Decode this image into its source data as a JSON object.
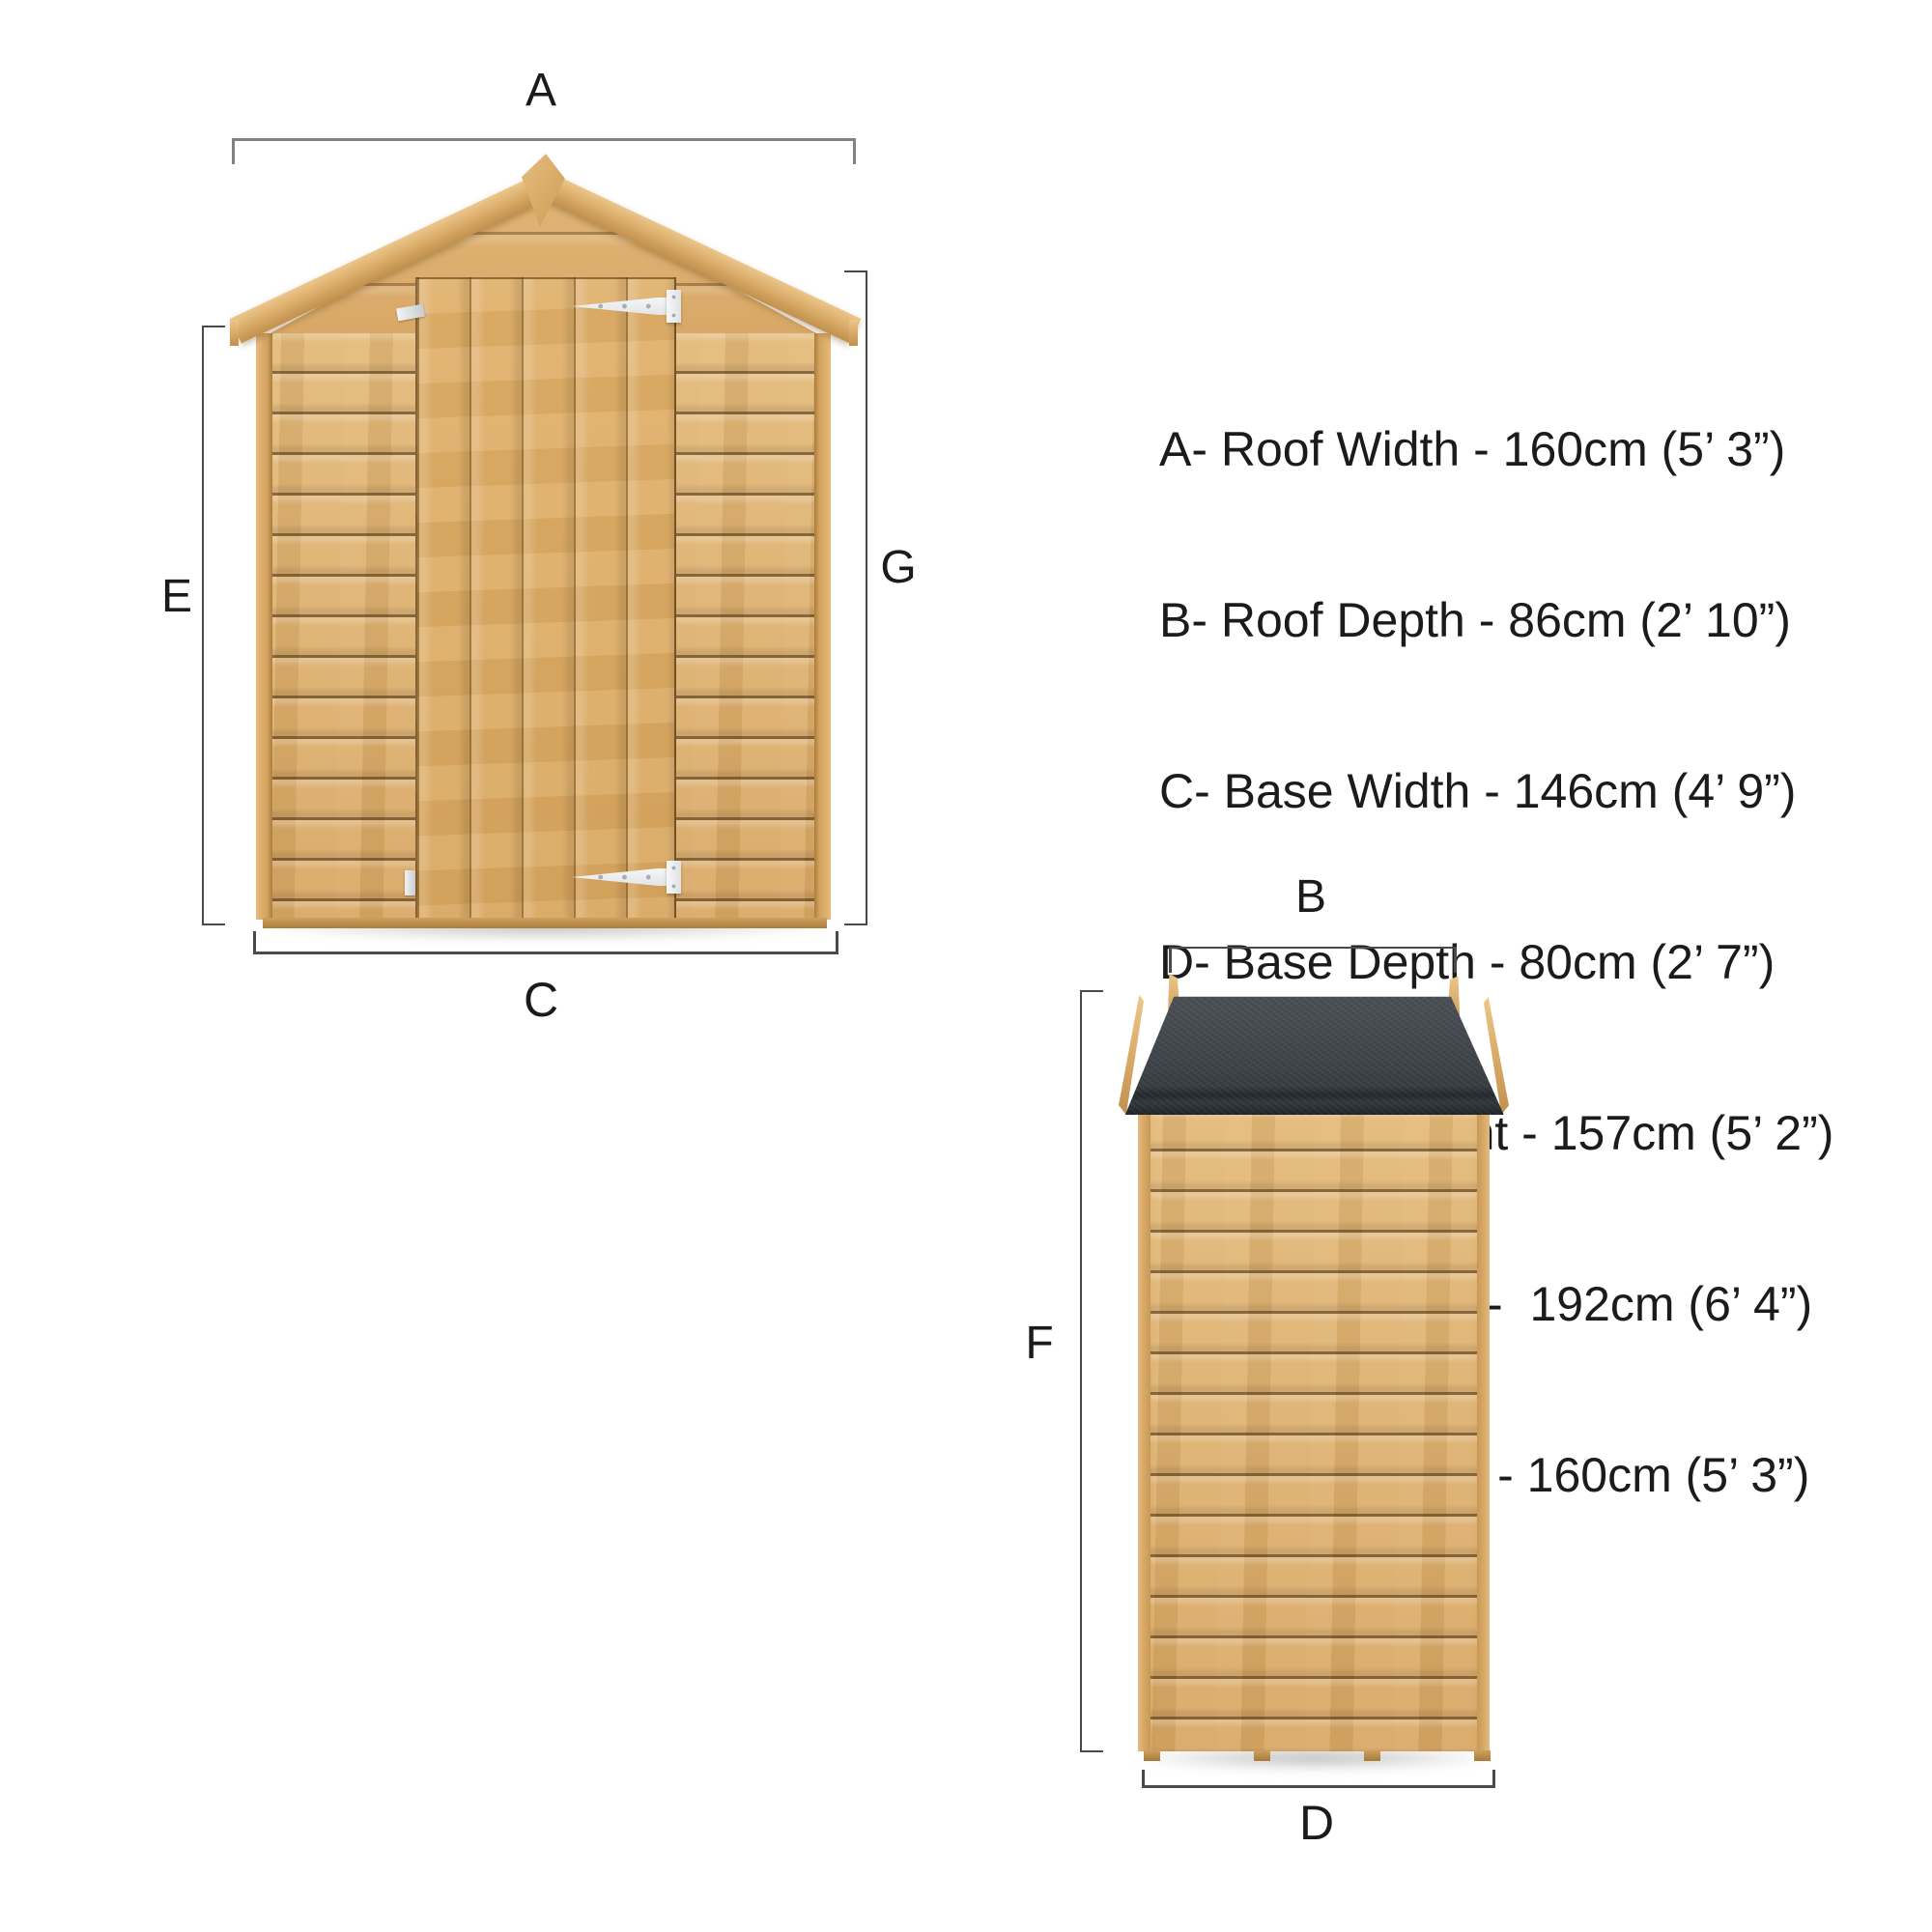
{
  "dimension_list": {
    "items": [
      "A- Roof Width - 160cm (5’ 3”)",
      "B- Roof Depth - 86cm (2’ 10”)",
      "C- Base Width - 146cm (4’ 9”)",
      "D- Base Depth - 80cm (2’ 7”)",
      "E- Eaves Height - 157cm (5’ 2”)",
      "F- Roof Height -  192cm (6’ 4”)",
      "G- Door Height - 160cm (5’ 3”)"
    ]
  },
  "front_view": {
    "roof_width_marker": "A",
    "base_width_marker": "C",
    "eaves_height_marker": "E",
    "door_height_marker": "G"
  },
  "side_view": {
    "roof_depth_marker": "B",
    "base_depth_marker": "D",
    "roof_height_marker": "F"
  },
  "colors": {
    "wood_mid": "#d9a967",
    "wood_light": "#e8c38c",
    "wood_shadow": "#a87b3c",
    "felt_dark": "#353b3f",
    "dim_line": "#4a4a4a",
    "dim_line_light": "#828282",
    "text": "#1b1b1b",
    "hinge_white": "#eef0f2"
  }
}
